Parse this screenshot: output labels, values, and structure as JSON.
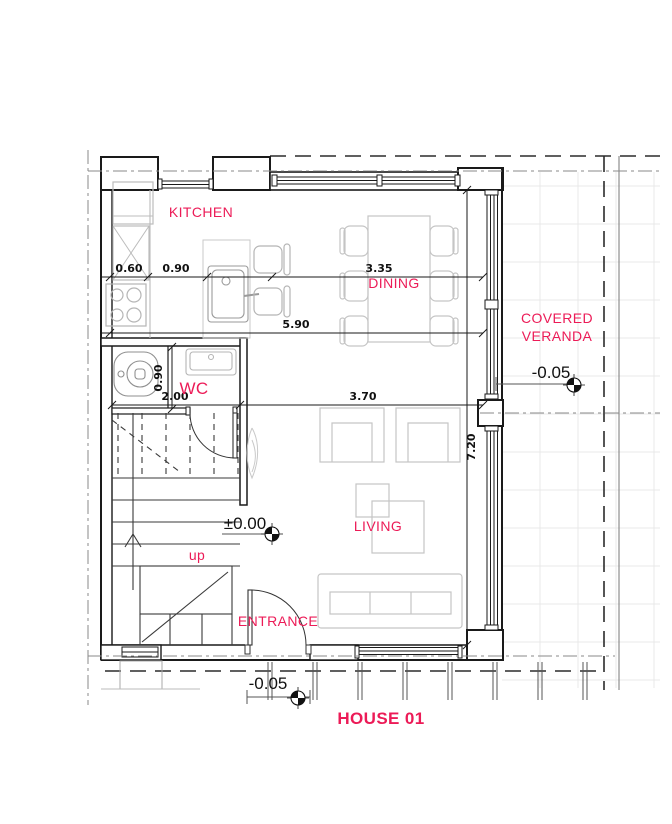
{
  "colors": {
    "accent": "#EC1B57",
    "ink": "#1a1a1a",
    "furniture_line": "#bcbcbc",
    "tile_grid": "#e9e9e9"
  },
  "title": {
    "text": "HOUSE 01"
  },
  "rooms": {
    "kitchen": {
      "label": "KITCHEN"
    },
    "dining": {
      "label": "DINING"
    },
    "wc": {
      "label": "WC"
    },
    "living": {
      "label": "LIVING"
    },
    "entrance": {
      "label": "ENTRANCE"
    },
    "veranda": {
      "label_line1": "COVERED",
      "label_line2": "VERANDA"
    }
  },
  "levels": {
    "interior": "±0.00",
    "veranda": "-0.05",
    "entrance": "-0.05"
  },
  "dimensions": {
    "top": {
      "d1": "0.60",
      "d2": "0.90",
      "d3": "3.35"
    },
    "middle": {
      "d1": "5.90"
    },
    "lower": {
      "d1": "2.00",
      "d2": "3.70"
    },
    "vertical": {
      "wc": "0.90",
      "right": "7.20"
    }
  },
  "stairs": {
    "direction": "up"
  }
}
